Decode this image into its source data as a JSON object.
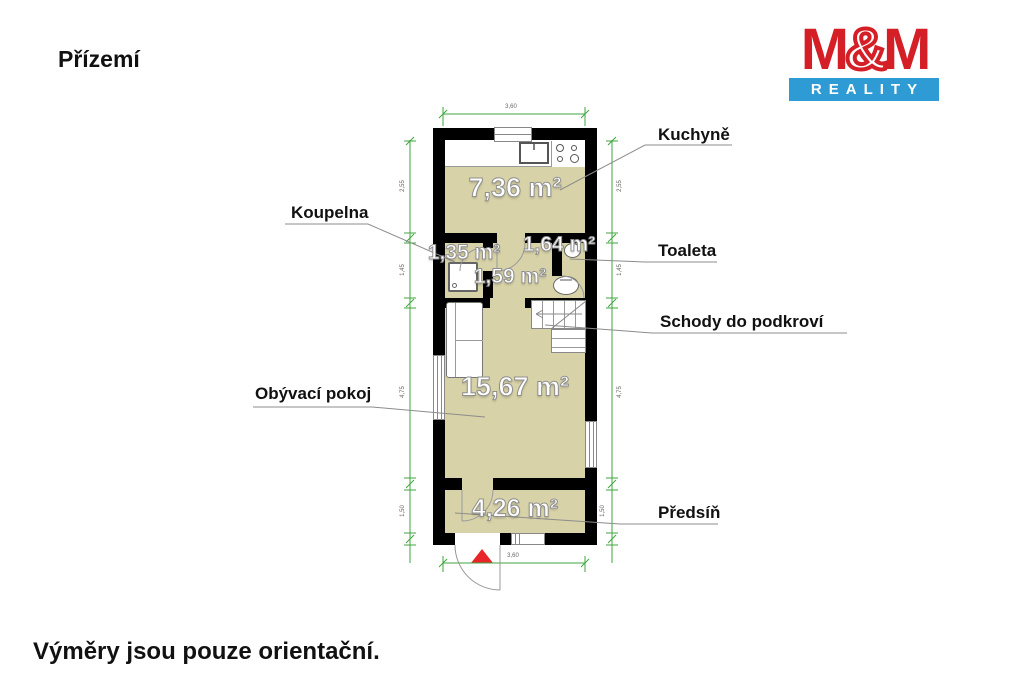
{
  "header": {
    "title": "Přízemí"
  },
  "footer": {
    "note": "Výměry jsou pouze orientační."
  },
  "logo": {
    "m1": "M",
    "amp": "&",
    "m2": "M",
    "subtitle": "REALITY"
  },
  "floorplan": {
    "callouts": {
      "kitchen": "Kuchyně",
      "bathroom": "Koupelna",
      "toilet": "Toaleta",
      "stairs": "Schody do podkroví",
      "living": "Obývací pokoj",
      "hallway": "Předsíň"
    },
    "areas": {
      "kitchen": "7,36 m²",
      "bathroom": "1,35 m²",
      "toilet": "1,64 m²",
      "corridor": "1,59 m²",
      "living": "15,67 m²",
      "hallway": "4,26 m²"
    },
    "dimensions": {
      "top": "3,60",
      "bottom": "3,60",
      "left": [
        "2,55",
        "1,45",
        "4,75",
        "1,50"
      ],
      "right": [
        "2,55",
        "1,45",
        "4,75",
        "1,50"
      ]
    },
    "colors": {
      "floor": "#d8d2a8",
      "wall": "#000000",
      "dimension_line": "#3fa63f",
      "entrance_marker": "#e8262a",
      "logo_red": "#d51f26",
      "logo_blue": "#2e9bd5"
    }
  }
}
